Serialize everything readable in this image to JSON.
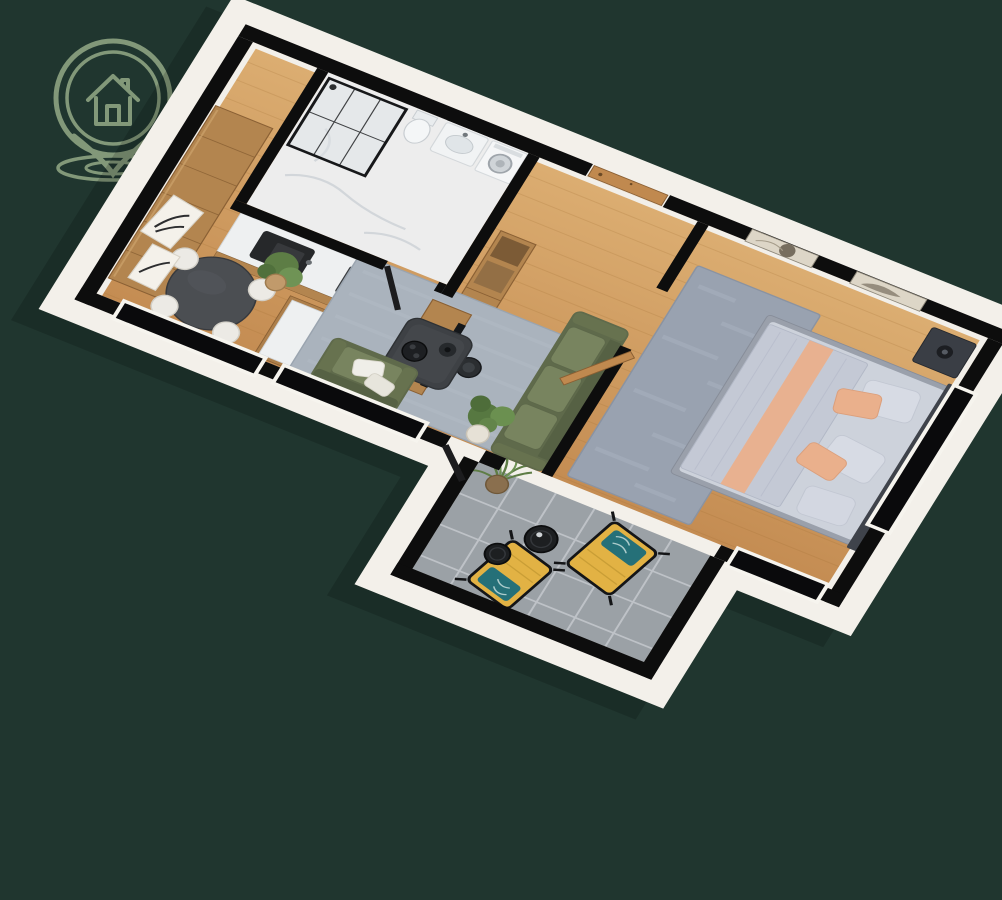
{
  "scene": {
    "type": "3d-floor-plan-render",
    "description": "Isometric 3D render of a one-bedroom apartment floor plan on a dark green background",
    "logo": {
      "name": "house-location-pin-logo"
    },
    "rooms": [
      {
        "name": "Kitchen & Dining",
        "items": [
          "wardrobe",
          "kitchen-counter",
          "sink",
          "cooktop",
          "kitchen-island",
          "dining-table",
          "dining-chairs",
          "potted-plant",
          "leaning-wall-art"
        ]
      },
      {
        "name": "Bathroom",
        "items": [
          "walk-in-shower",
          "toilet",
          "washbasin",
          "mirror",
          "washing-machine"
        ]
      },
      {
        "name": "Hallway",
        "items": [
          "entrance-door",
          "console-cabinet"
        ]
      },
      {
        "name": "Living Room",
        "items": [
          "sofa",
          "coffee-table",
          "tv-cabinet",
          "tv",
          "armchair",
          "area-rug",
          "floor-plant",
          "stool"
        ]
      },
      {
        "name": "Bedroom",
        "items": [
          "double-bed",
          "headboard",
          "nightstand",
          "table-lamp",
          "bedroom-rug",
          "wall-art-frames",
          "open-door"
        ]
      },
      {
        "name": "Terrace",
        "items": [
          "lounge-chair",
          "lounge-chair",
          "side-table",
          "side-table",
          "planter"
        ]
      }
    ]
  },
  "palette": {
    "background": "#20362f",
    "logo": "#8ba180",
    "wall": "#0d0d0d",
    "wallFace": "#f3f0ea",
    "innerFace": "#f2efe9",
    "woodLight": "#dcae72",
    "woodDark": "#c48c52",
    "cabinetWood": "#b3854f",
    "marble": "#eef0f1",
    "bathFloor": "#ededed",
    "rugLiving": "#aab3bd",
    "rugBedroom": "#99a2b0",
    "sofa": "#5f6a4b",
    "cushion": "#78845f",
    "coffeeTable": "#3e4145",
    "diningTable": "#4b4e52",
    "chairWhite": "#eceae5",
    "terraceTile": "#9ba1a6",
    "loungeYellow": "#e2b244",
    "pillowTeal": "#257078",
    "bedLinen": "#cdd2db",
    "pillowPeach": "#eab08c",
    "plant": "#5d7d45",
    "doorWood": "#c0894f",
    "shadow": "#000000"
  }
}
